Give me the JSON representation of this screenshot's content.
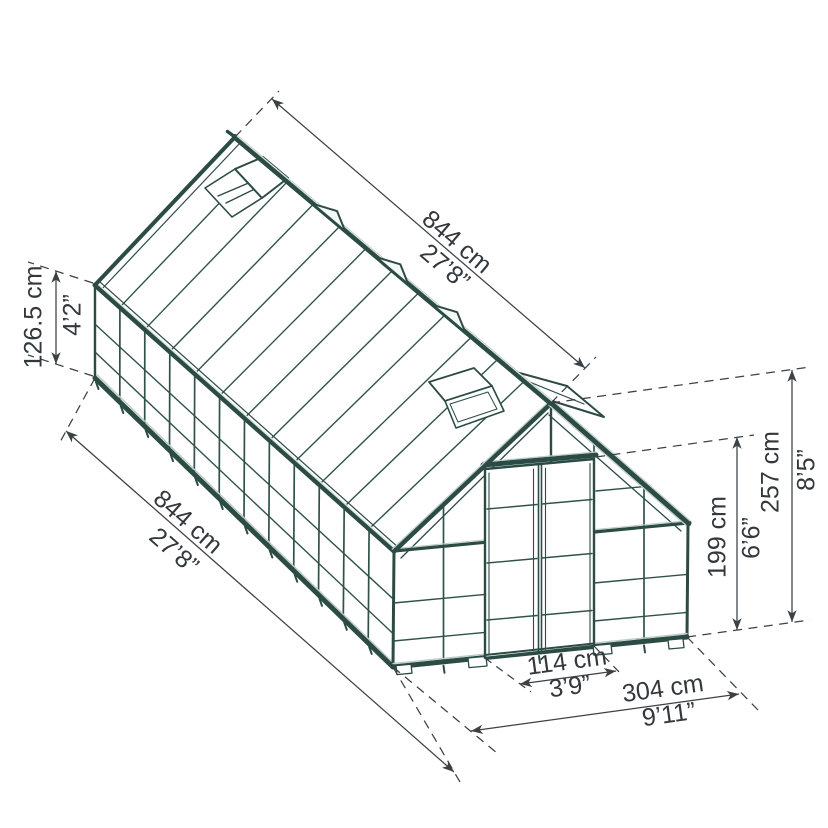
{
  "diagram": {
    "description": "Isometric wireframe drawing of a gabled greenhouse with seven dimension annotations",
    "colors": {
      "frame": "#2c4b45",
      "frame_light": "#bccbc7",
      "dimension_lines": "#3b4145",
      "dimension_text": "#33383c",
      "background": "#ffffff"
    },
    "dims": {
      "roof_length": {
        "cm": "844 cm",
        "ft": "27’8”"
      },
      "wall_height": {
        "cm": "126.5 cm",
        "ft": "4’2”"
      },
      "side_length": {
        "cm": "844 cm",
        "ft": "27’8”"
      },
      "ridge_height": {
        "cm": "257 cm",
        "ft": "8’5”"
      },
      "door_height": {
        "cm": "199 cm",
        "ft": "6’6”"
      },
      "door_width": {
        "cm": "114 cm",
        "ft": "3’9”"
      },
      "front_width": {
        "cm": "304 cm",
        "ft": "9’11”"
      }
    }
  }
}
